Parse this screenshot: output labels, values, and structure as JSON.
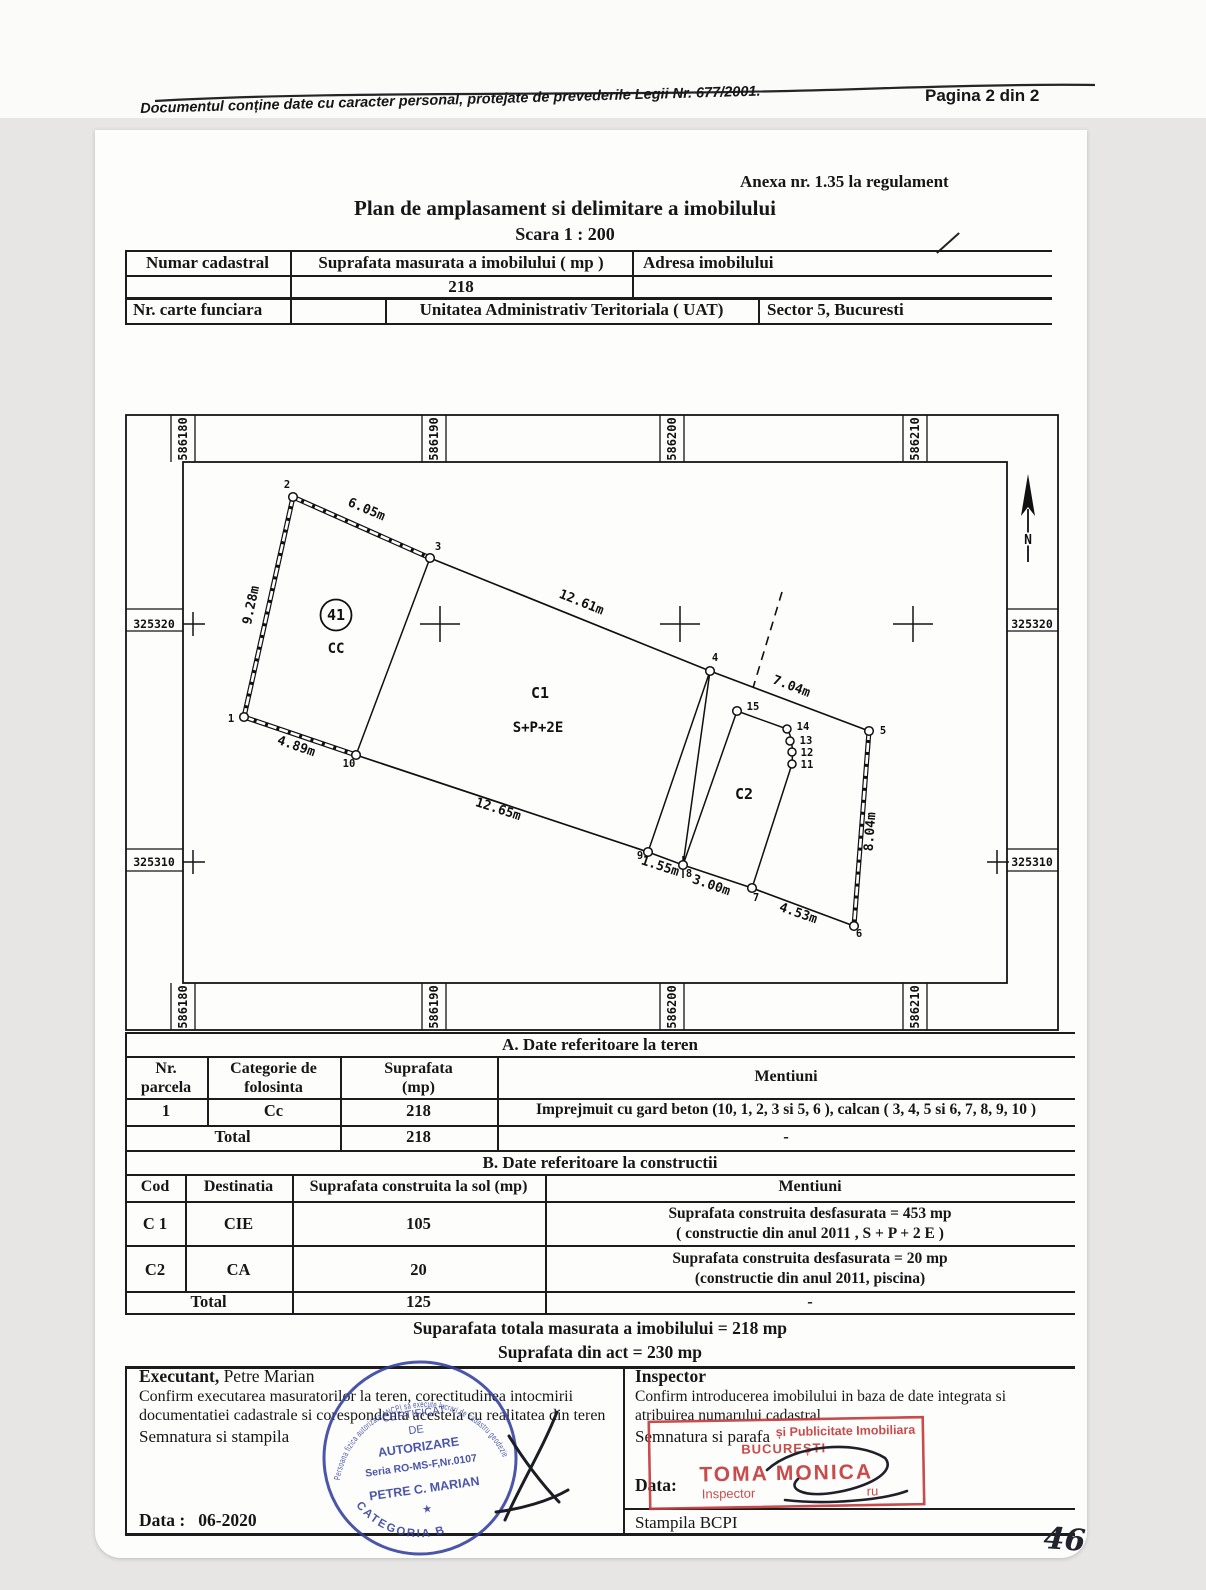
{
  "page": {
    "handwritten_number": "46"
  },
  "header": {
    "privacy_note": "Documentul conține date cu caracter personal, protejate de prevederile Legii Nr. 677/2001.",
    "page_label": "Pagina 2 din  2"
  },
  "title_block": {
    "annex": "Anexa nr. 1.35 la regulament",
    "title": "Plan de amplasament si delimitare a imobilului",
    "scale": "Scara 1 : 200"
  },
  "id_table": {
    "numar_cadastral_label": "Numar cadastral",
    "suprafata_label": "Suprafata masurata a imobilului ( mp )",
    "suprafata_value": "218",
    "adresa_label": "Adresa imobilului",
    "carte_funciara_label": "Nr. carte funciara",
    "uat_label": "Unitatea Administrativ Teritoriala ( UAT)",
    "uat_value": "Sector 5, Bucuresti"
  },
  "plan": {
    "grid_x": [
      "586180",
      "586190",
      "586200",
      "586210"
    ],
    "grid_y": [
      "325320",
      "325310"
    ],
    "north": "N",
    "parcel_no": "41",
    "cc": "CC",
    "c1": "C1",
    "c1_regime": "S+P+2E",
    "c2": "C2",
    "points": {
      "p1": "1",
      "p2": "2",
      "p3": "3",
      "p4": "4",
      "p5": "5",
      "p6": "6",
      "p7": "7",
      "p8": "8",
      "p9": "9",
      "p10": "10",
      "p11": "11",
      "p12": "12",
      "p13": "13",
      "p14": "14",
      "p15": "15"
    },
    "dims": {
      "d1_2": "9.28m",
      "d2_3": "6.05m",
      "d3_4": "12.61m",
      "d4_5": "7.04m",
      "d5_6": "8.04m",
      "d6_7": "4.53m",
      "d7_8": "3.00m",
      "d8_9": "1.55m",
      "d9_10": "12.65m",
      "d10_1": "4.89m"
    }
  },
  "table_a": {
    "title": "A. Date referitoare la teren",
    "col_parcela": "Nr.\nparcela",
    "col_categorie": "Categorie de\nfolosinta",
    "col_suprafata": "Suprafata\n(mp)",
    "col_mentiuni": "Mentiuni",
    "row": {
      "nr": "1",
      "categorie": "Cc",
      "suprafata": "218",
      "mentiuni": "Imprejmuit cu gard beton (10, 1, 2, 3 si 5, 6 ), calcan ( 3, 4, 5 si 6, 7, 8, 9, 10 )"
    },
    "total_label": "Total",
    "total_suprafata": "218",
    "total_mentiuni": "-"
  },
  "table_b": {
    "title": "B. Date referitoare la constructii",
    "col_cod": "Cod",
    "col_destinatia": "Destinatia",
    "col_suprafata": "Suprafata construita la sol (mp)",
    "col_mentiuni": "Mentiuni",
    "rows": [
      {
        "cod": "C 1",
        "dest": "CIE",
        "supr": "105",
        "mentiuni": "Suprafata construita desfasurata = 453 mp\n( constructie din anul 2011 , S + P + 2 E )"
      },
      {
        "cod": "C2",
        "dest": "CA",
        "supr": "20",
        "mentiuni": "Suprafata construita desfasurata = 20 mp\n(constructie din anul 2011, piscina)"
      }
    ],
    "total_label": "Total",
    "total_suprafata": "125",
    "total_mentiuni": "-"
  },
  "totals": {
    "measured": "Suparafata totala masurata a imobilului = 218 mp",
    "act": "Suprafata din act =  230 mp"
  },
  "executant": {
    "role": "Executant,",
    "name": " Petre Marian",
    "confirm": "Confirm executarea masuratorilor la teren, corectitudinea intocmirii documentatiei cadastrale si corespondenta acesteia cu realitatea din teren",
    "sign_label": "Semnatura si stampila",
    "date_label": "Data :",
    "date_value": "06-2020"
  },
  "inspector": {
    "role": "Inspector",
    "confirm": "Confirm introducerea imobilului in baza de date integrata si atribuirea numarului cadastral",
    "sign_label": "Semnatura si parafa",
    "date_label": "Data:",
    "stamp_label": "Stampila BCPI"
  },
  "stamps": {
    "blue": {
      "color": "#33409f",
      "ring_text": "Persoana fizica autorizata ANCPI sa execute lucrari de cadastru geodezie si cartografie",
      "l1": "CERTIFICAT",
      "l2": "DE",
      "l3": "AUTORIZARE",
      "l4": "Seria RO-MS-F,Nr.0107",
      "l5": "PETRE C. MARIAN",
      "star": "★",
      "bottom": "CATEGORIA B"
    },
    "red": {
      "color": "#c43d3d",
      "l1": "și Publicitate Imobiliara",
      "l2": "BUCUREȘTI",
      "l3": "TOMA MONICA",
      "l4": "Inspector",
      "l4b": "ru"
    }
  }
}
